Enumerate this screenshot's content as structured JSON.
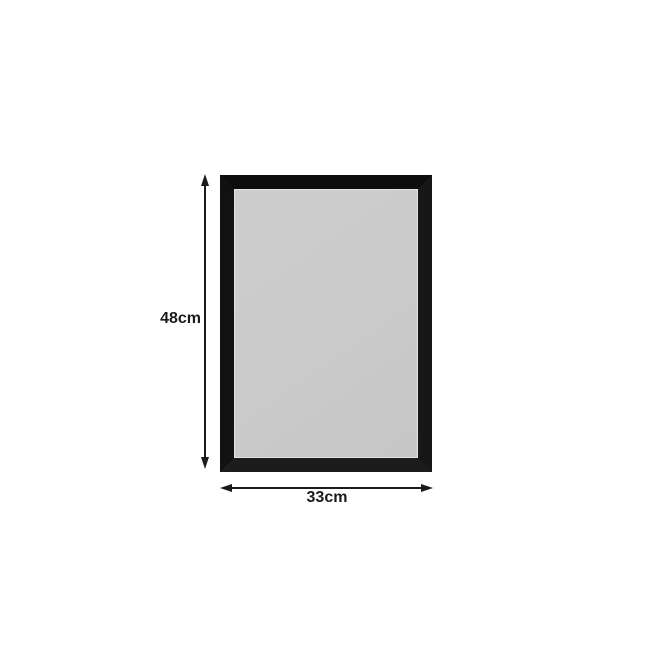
{
  "canvas": {
    "background": "#ffffff"
  },
  "diagram": {
    "name": "framed-board-dimension-diagram",
    "frame": {
      "color": "#111111",
      "surface_color": "#cacaca",
      "highlight_color": "#e3e3e3"
    },
    "annotations": {
      "color": "#1b1b1b",
      "height_label": "48cm",
      "width_label": "33cm",
      "height_arrow_icon": "vertical-double-arrow",
      "width_arrow_icon": "horizontal-double-arrow"
    }
  }
}
